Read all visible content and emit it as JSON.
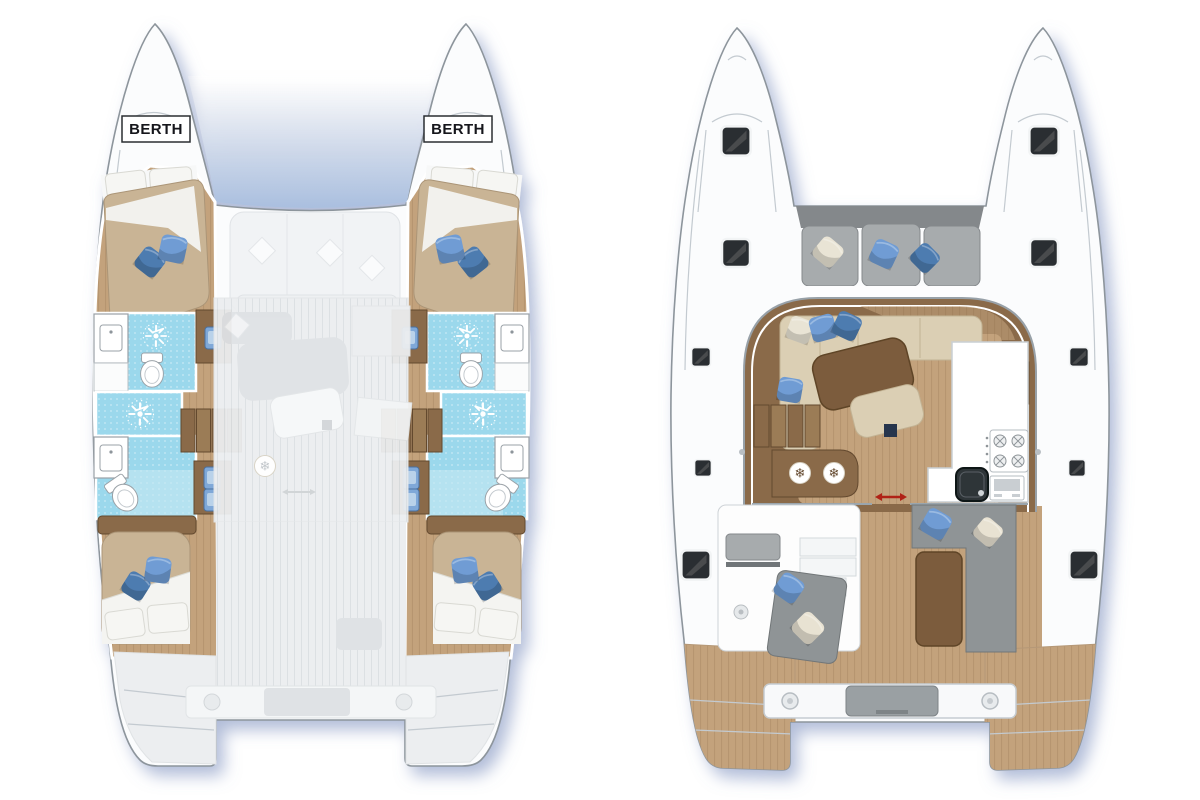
{
  "page": {
    "background": "#ffffff"
  },
  "palette": {
    "hull": "#fbfcfd",
    "hull_stroke": "#8d959c",
    "detail_line": "#c3cad0",
    "shadow": "#6f86b8",
    "wood_floor": "#c3a27c",
    "wood_stripe": "#9d7e57",
    "wood_dark": "#8a6a49",
    "wood_darker": "#64492f",
    "table_brown": "#7b5b3c",
    "mattress": "#c9b495",
    "mattress_edge": "#ab9577",
    "cream": "#dbcfb4",
    "cream_edge": "#c2b394",
    "white_cushion": "#f6f6f3",
    "white_cushion_edge": "#d9d9d3",
    "pillow_blue": "#6f9cd4",
    "pillow_blue_dark": "#4e7cb0",
    "tile": "#9bd8ec",
    "tile_light": "#c6e9f4",
    "gray_cushion": "#a7abad",
    "gray_cushion_dark": "#84888b",
    "gray_seat": "#8f9496",
    "faded": "#eceef0",
    "faded_mid": "#dfe2e5",
    "faded_dark": "#d2d6d9",
    "hatch": "#2c2f31",
    "red_accent": "#b02418",
    "tramp_blue": "#aabfdf"
  },
  "left_plan": {
    "berth_port": "BERTH",
    "berth_starboard": "BERTH"
  },
  "right_plan": {},
  "icons": {
    "shower": "sunburst-shower-icon",
    "toilet": "toilet-icon",
    "sink": "sink-icon",
    "washbasin": "cabin-washbasin-icon",
    "fridge": "snowflake-fridge-icon",
    "stove": "stove-burners-icon",
    "oven": "oven-icon",
    "galley_sink": "galley-sink-icon",
    "hatch": "deck-hatch-icon",
    "sliding_door": "sliding-door-arrow-icon",
    "mooring_ring": "mooring-ring-icon",
    "pillow": "pillow-icon",
    "stairs": "companionway-stairs"
  }
}
